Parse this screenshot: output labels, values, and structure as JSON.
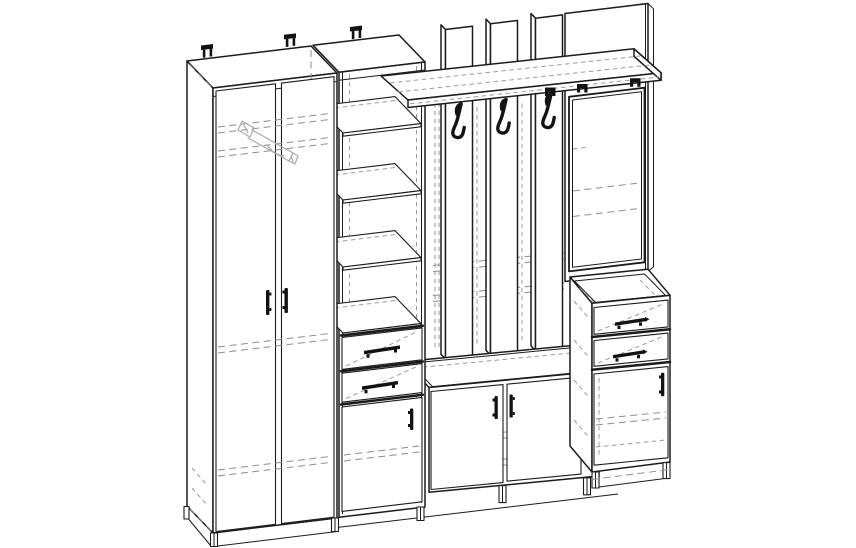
{
  "document": {
    "type": "technical line drawing",
    "subject": "Hallway entryway furniture set: two-door wardrobe, open shelf column with drawers, coat-rack panel with hooks and hat shelf, mirror, low shoe bench and drawer cabinet",
    "background_color": "#ffffff",
    "canvas": {
      "width": 856,
      "height": 548
    }
  },
  "style": {
    "outline_color": "#1b1b1b",
    "hidden_line_color": "#8d8d8d",
    "sketch_detail_color": "#a9a9a9",
    "hardware_fill": "#121212",
    "projection": "oblique wireframe with dashed hidden edges"
  },
  "components": {
    "wardrobe": {
      "label": "two-door wardrobe",
      "doors": 2,
      "handles": 2,
      "hidden_details": [
        "clothes rail",
        "hanger bracket",
        "interior shelves"
      ]
    },
    "shelf_column": {
      "label": "open shelving column",
      "shelves": 4,
      "drawers": 2,
      "doors": 1
    },
    "coat_rack": {
      "label": "coat-rack wall panel",
      "slats": 3,
      "hooks": 3
    },
    "hat_shelf": {
      "label": "top hat shelf",
      "brackets": 3
    },
    "mirror": {
      "label": "framed mirror on tall back panel"
    },
    "bench": {
      "label": "low two-door shoe cabinet",
      "doors": 2,
      "handles": 2
    },
    "drawer_cabinet": {
      "label": "bedside drawer cabinet",
      "drawers": 2,
      "doors": 1,
      "legs": 2
    },
    "wall_brackets": {
      "label": "wall-mount brackets on top edges",
      "count": 3
    }
  }
}
